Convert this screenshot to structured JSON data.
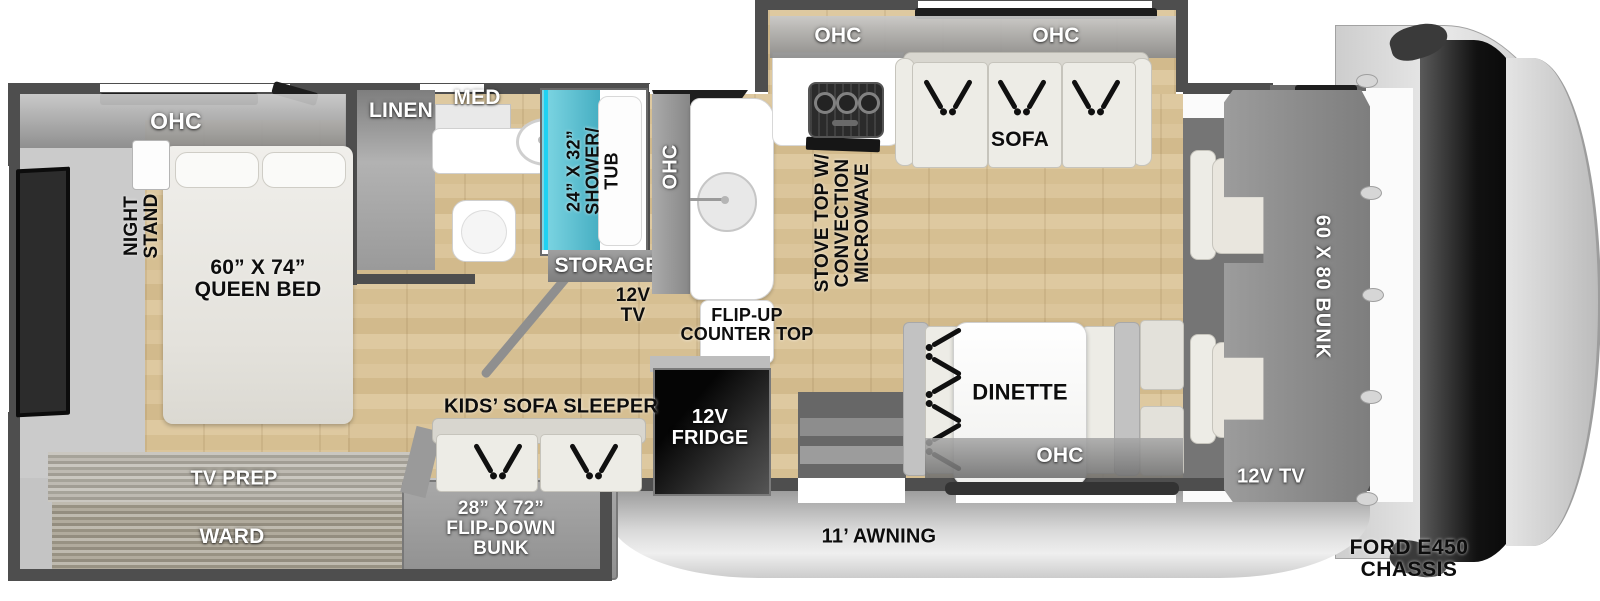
{
  "image_type": "rv-floorplan-top-view",
  "colors": {
    "wall": "#4e4e4e",
    "wood_floor": "#d9c49a",
    "shower_teal": "#56c2d4",
    "fridge_black": "#111111"
  },
  "labels": {
    "bedroom_ohc": "OHC",
    "night_stand": "NIGHT\nSTAND",
    "queen_bed": "60” X 74”\nQUEEN BED",
    "tv_prep": "TV PREP",
    "ward": "WARD",
    "linen": "LINEN",
    "med": "MED",
    "shower": "24” X 32”\nSHOWER/\nTUB",
    "storage": "STORAGE",
    "tv_12v": "12V\nTV",
    "kitchen_ohc": "OHC",
    "flip_up_counter": "FLIP-UP\nCOUNTER TOP",
    "stove": "STOVE TOP W/\nCONVECTION\nMICROWAVE",
    "stove_ohc": "OHC",
    "sofa_ohc": "OHC",
    "sofa": "SOFA",
    "dinette": "DINETTE",
    "dinette_ohc": "OHC",
    "fridge": "12V\nFRIDGE",
    "kids_sofa": "KIDS’ SOFA SLEEPER",
    "flip_down_bunk": "28” X 72”\nFLIP-DOWN\nBUNK",
    "awning": "11’ AWNING",
    "bunk": "60 X 80 BUNK",
    "cab_tv": "12V TV",
    "chassis": "FORD E450 CHASSIS"
  }
}
